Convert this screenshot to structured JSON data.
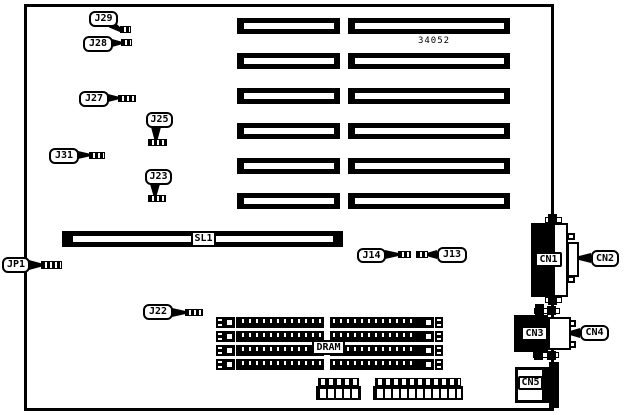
{
  "page": {
    "background": "#ffffff",
    "ink": "#000000"
  },
  "board": {
    "part_number": "34052",
    "slot_label": "SL1",
    "dram_label": "DRAM",
    "jumper_labels": {
      "j29": "J29",
      "j28": "J28",
      "j27": "J27",
      "j25": "J25",
      "j31": "J31",
      "j23": "J23",
      "jp1": "JP1",
      "j22": "J22",
      "j14": "J14",
      "j13": "J13"
    },
    "connector_labels": {
      "cn1": "CN1",
      "cn2": "CN2",
      "cn3": "CN3",
      "cn4": "CN4",
      "cn5": "CN5"
    },
    "structure": {
      "expansion_slot_rows": 6,
      "expansion_slot_columns": 2,
      "simm_sockets": 4,
      "bottom_pin_headers": 2
    }
  }
}
